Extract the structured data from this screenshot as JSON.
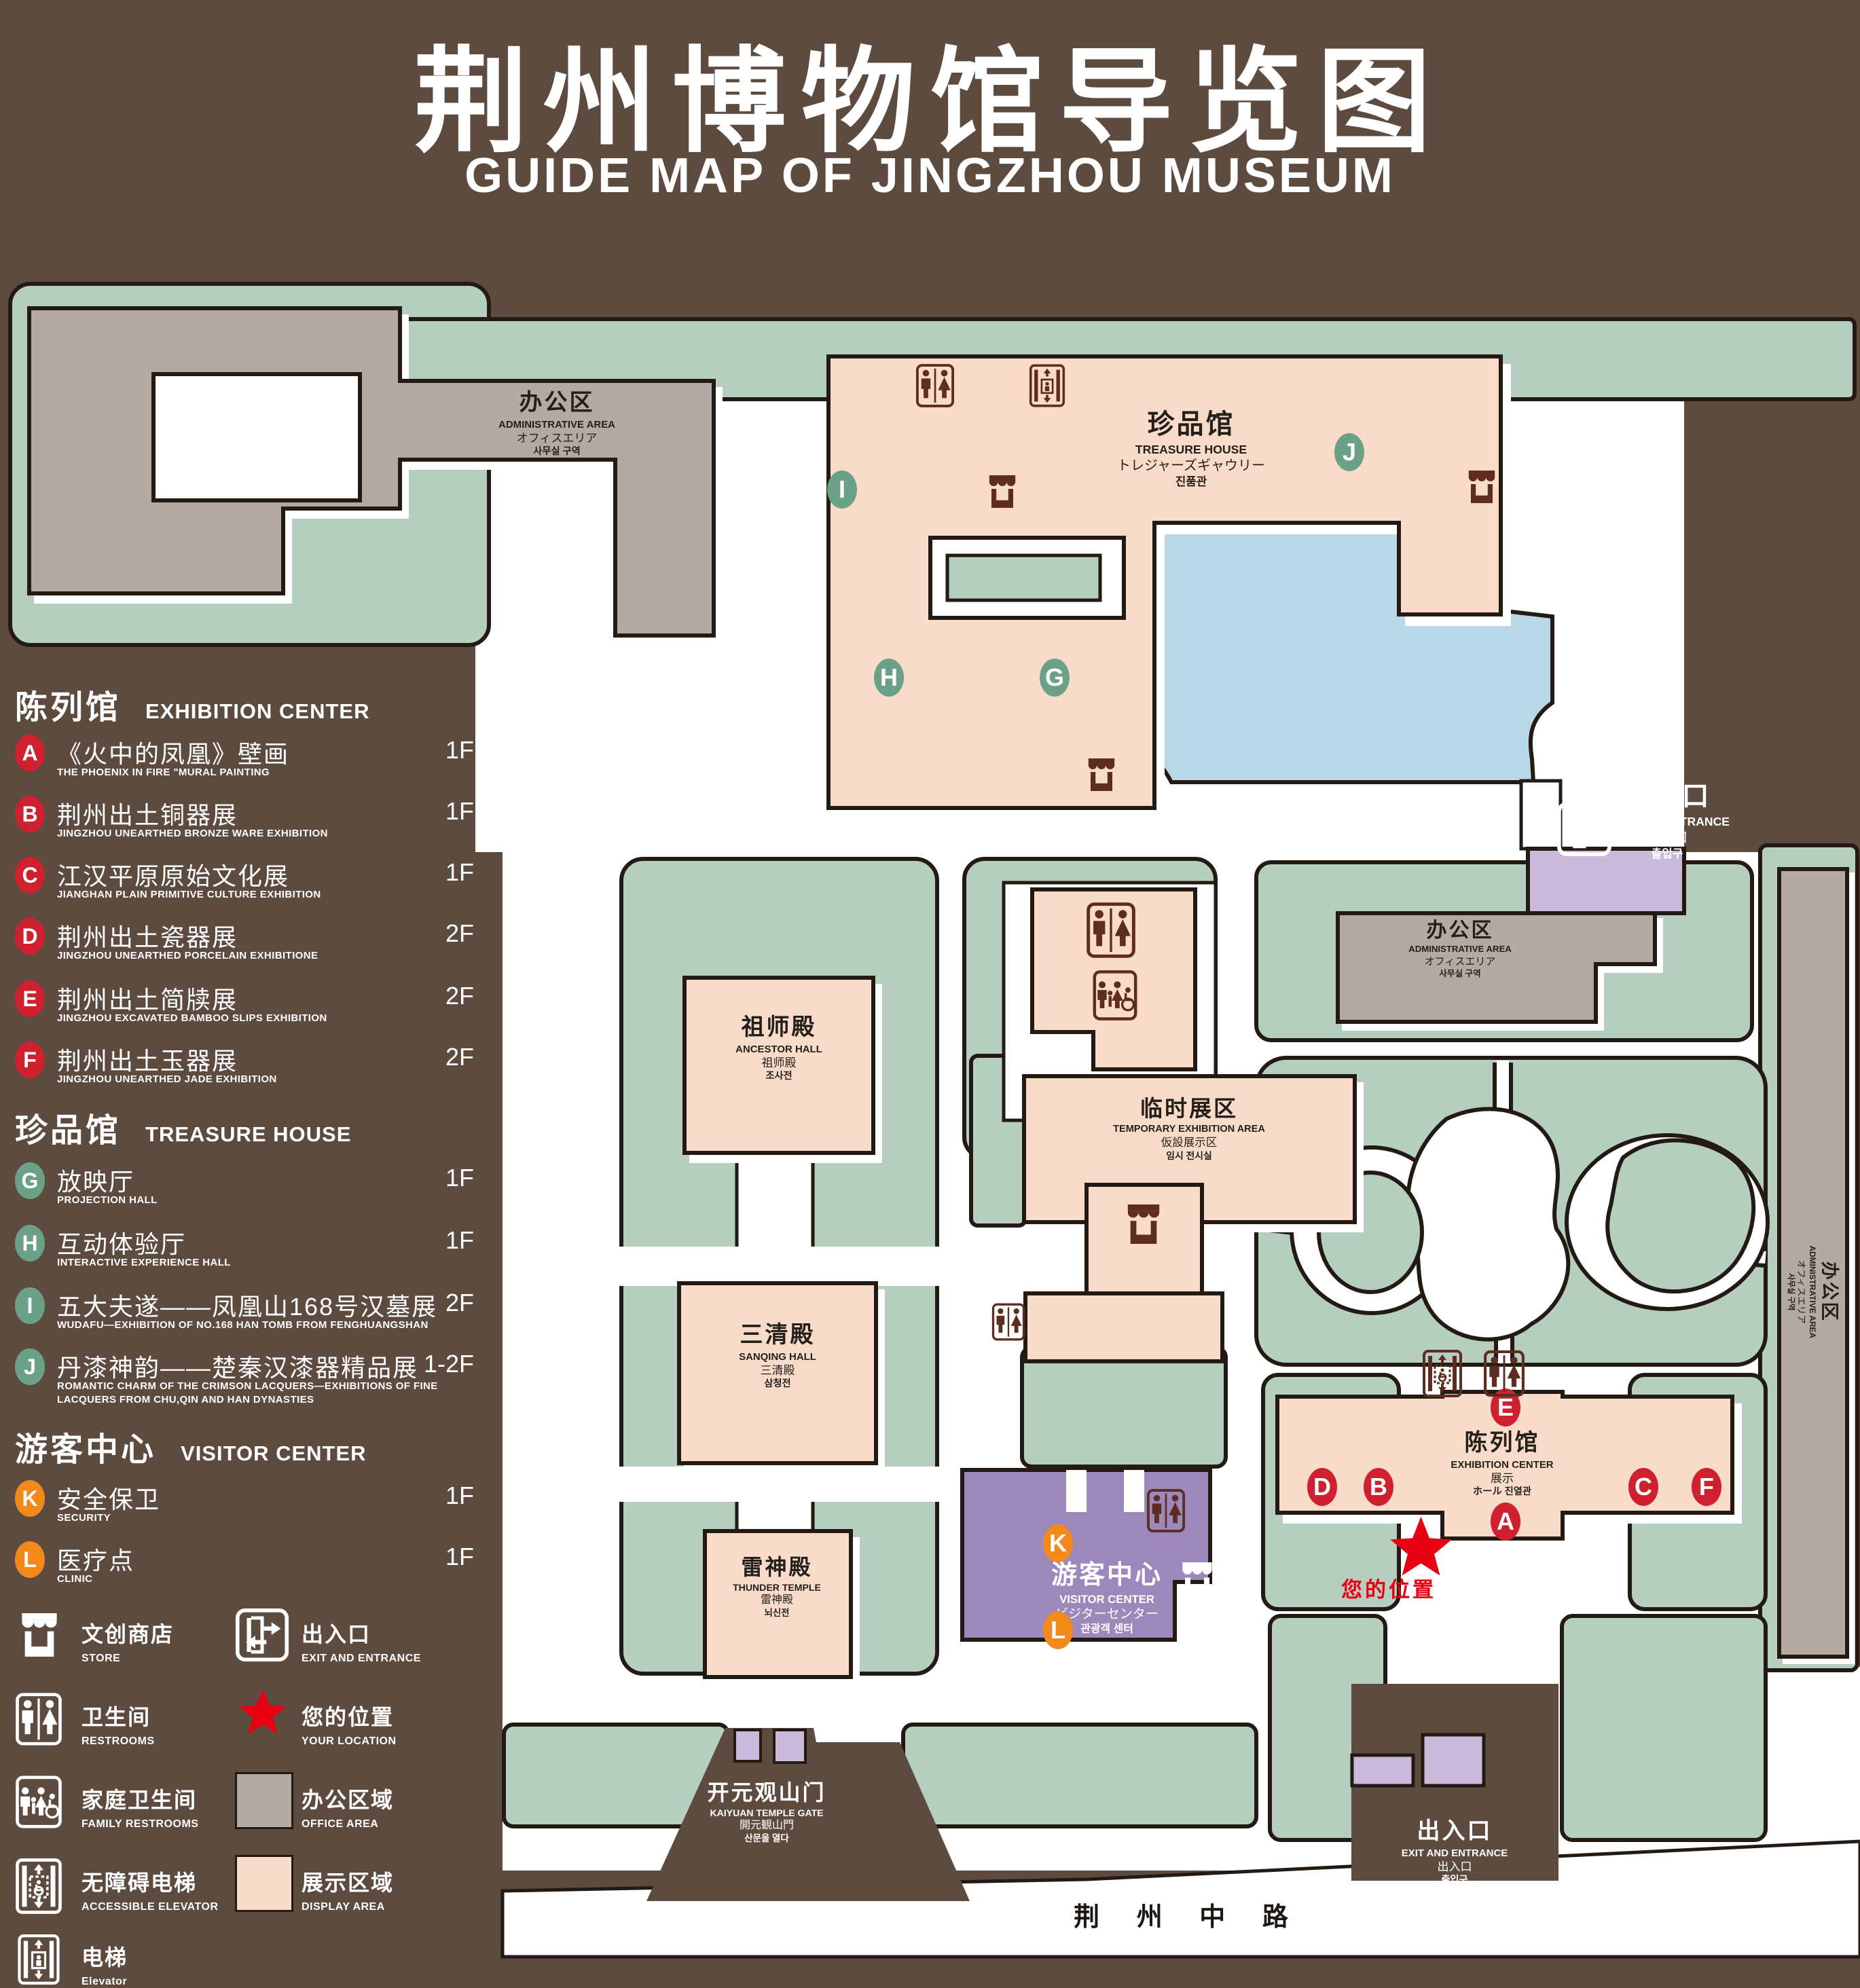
{
  "title": {
    "zh": "荆州博物馆导览图",
    "en": "GUIDE MAP OF JINGZHOU MUSEUM"
  },
  "legend": {
    "sections": [
      {
        "zh": "陈列馆",
        "en": "EXHIBITION CENTER",
        "items": [
          {
            "letter": "A",
            "zh": "《火中的凤凰》壁画",
            "en": "THE PHOENIX IN FIRE \"MURAL PAINTING",
            "floor": "1F"
          },
          {
            "letter": "B",
            "zh": "荆州出土铜器展",
            "en": "JINGZHOU UNEARTHED BRONZE WARE EXHIBITION",
            "floor": "1F"
          },
          {
            "letter": "C",
            "zh": "江汉平原原始文化展",
            "en": "JIANGHAN PLAIN PRIMITIVE CULTURE EXHIBITION",
            "floor": "1F"
          },
          {
            "letter": "D",
            "zh": "荆州出土瓷器展",
            "en": "JINGZHOU UNEARTHED PORCELAIN EXHIBITIONE",
            "floor": "2F"
          },
          {
            "letter": "E",
            "zh": "荆州出土简牍展",
            "en": "JINGZHOU EXCAVATED BAMBOO SLIPS EXHIBITION",
            "floor": "2F"
          },
          {
            "letter": "F",
            "zh": "荆州出土玉器展",
            "en": "JINGZHOU UNEARTHED JADE EXHIBITION",
            "floor": "2F"
          }
        ]
      },
      {
        "zh": "珍品馆",
        "en": "TREASURE HOUSE",
        "items": [
          {
            "letter": "G",
            "zh": "放映厅",
            "en": "PROJECTION HALL",
            "floor": "1F"
          },
          {
            "letter": "H",
            "zh": "互动体验厅",
            "en": "INTERACTIVE EXPERIENCE HALL",
            "floor": "1F"
          },
          {
            "letter": "I",
            "zh": "五大夫遂——凤凰山168号汉墓展",
            "en": "WUDAFU—EXHIBITION OF NO.168 HAN TOMB FROM FENGHUANGSHAN",
            "floor": "2F"
          },
          {
            "letter": "J",
            "zh": "丹漆神韵——楚秦汉漆器精品展",
            "en": "ROMANTIC CHARM OF THE CRIMSON LACQUERS—EXHIBITIONS OF FINE LACQUERS FROM CHU,QIN AND HAN DYNASTIES",
            "floor": "1-2F"
          }
        ]
      },
      {
        "zh": "游客中心",
        "en": "VISITOR CENTER",
        "items": [
          {
            "letter": "K",
            "zh": "安全保卫",
            "en": "SECURITY",
            "floor": "1F"
          },
          {
            "letter": "L",
            "zh": "医疗点",
            "en": "CLINIC",
            "floor": "1F"
          }
        ]
      }
    ],
    "symbols": [
      {
        "name": "store",
        "zh": "文创商店",
        "en": "STORE"
      },
      {
        "name": "restrooms",
        "zh": "卫生间",
        "en": "RESTROOMS"
      },
      {
        "name": "family-restrooms",
        "zh": "家庭卫生间",
        "en": "FAMILY RESTROOMS"
      },
      {
        "name": "accessible-elevator",
        "zh": "无障碍电梯",
        "en": "ACCESSIBLE ELEVATOR"
      },
      {
        "name": "elevator",
        "zh": "电梯",
        "en": "Elevator"
      },
      {
        "name": "exit",
        "zh": "出入口",
        "en": "EXIT AND ENTRANCE"
      },
      {
        "name": "your-location",
        "zh": "您的位置",
        "en": "YOUR LOCATION"
      },
      {
        "name": "office-area",
        "zh": "办公区域",
        "en": "OFFICE AREA"
      },
      {
        "name": "display-area",
        "zh": "展示区域",
        "en": "DISPLAY AREA"
      }
    ]
  },
  "map": {
    "labels": {
      "admin_top": {
        "zh": "办公区",
        "en": "ADMINISTRATIVE AREA",
        "jp": "オフィスエリア",
        "kr": "사무실 구역"
      },
      "admin_right": {
        "zh": "办公区",
        "en": "ADMINISTRATIVE AREA",
        "jp": "オフィスエリア",
        "kr": "사무실 구역"
      },
      "admin_strip": {
        "zh": "办公区",
        "en": "ADMINISTRATIVE AREA",
        "jp": "オフィスエリア",
        "kr": "사무실 구역"
      },
      "treasure_house": {
        "zh": "珍品馆",
        "en": "TREASURE HOUSE",
        "jp": "トレジャーズギャウリー",
        "kr": "진품관"
      },
      "ancestor_hall": {
        "zh": "祖师殿",
        "en": "ANCESTOR HALL",
        "jp": "祖师殿",
        "kr": "조사전"
      },
      "temporary_area": {
        "zh": "临时展区",
        "en": "TEMPORARY EXHIBITION AREA",
        "jp": "仮設展示区",
        "kr": "임시 전시실"
      },
      "sanqing_hall": {
        "zh": "三清殿",
        "en": "SANQING HALL",
        "jp": "三清殿",
        "kr": "삼청전"
      },
      "thunder_temple": {
        "zh": "雷神殿",
        "en": "THUNDER TEMPLE",
        "jp": "雷神殿",
        "kr": "뇌신전"
      },
      "visitor_center": {
        "zh": "游客中心",
        "en": "VISITOR CENTER",
        "jp": "ビジターセンター",
        "kr": "관광객 센터"
      },
      "exhibition_center": {
        "zh": "陈列馆",
        "en": "EXHIBITION CENTER",
        "jp": "展示",
        "kr": "ホール 진열관"
      },
      "exit_top": {
        "zh": "出入口",
        "en": "EXIT AND ENTRANCE",
        "jp": "出入口",
        "kr": "출입구"
      },
      "exit_bottom": {
        "zh": "出入口",
        "en": "EXIT AND ENTRANCE",
        "jp": "出入口",
        "kr": "출입구"
      },
      "kaiyuan_gate": {
        "zh": "开元观山门",
        "en": "KAIYUAN TEMPLE GATE",
        "jp": "開元観山門",
        "kr": "산문을 열다"
      },
      "road": "荆 州 中 路",
      "your_location": "您的位置"
    },
    "markers": [
      {
        "letter": "A",
        "group": "red"
      },
      {
        "letter": "B",
        "group": "red"
      },
      {
        "letter": "C",
        "group": "red"
      },
      {
        "letter": "D",
        "group": "red"
      },
      {
        "letter": "E",
        "group": "red"
      },
      {
        "letter": "F",
        "group": "red"
      },
      {
        "letter": "G",
        "group": "green"
      },
      {
        "letter": "H",
        "group": "green"
      },
      {
        "letter": "I",
        "group": "green"
      },
      {
        "letter": "J",
        "group": "green"
      },
      {
        "letter": "K",
        "group": "orange"
      },
      {
        "letter": "L",
        "group": "orange"
      }
    ]
  },
  "colors": {
    "background": "#5e4b3f",
    "lawn": "#b6cec0",
    "display_area": "#f8dcc9",
    "office_area": "#b2aaa3",
    "visitor_center": "#9d88bc",
    "gate_accent": "#c9badb",
    "lake": "#b9d8e7",
    "outline": "#221a13",
    "icon_dark": "#5f2c22",
    "marker_red": "#ce202f",
    "marker_green": "#6ba287",
    "marker_orange": "#f28a1b",
    "your_location_red": "#e60012"
  }
}
